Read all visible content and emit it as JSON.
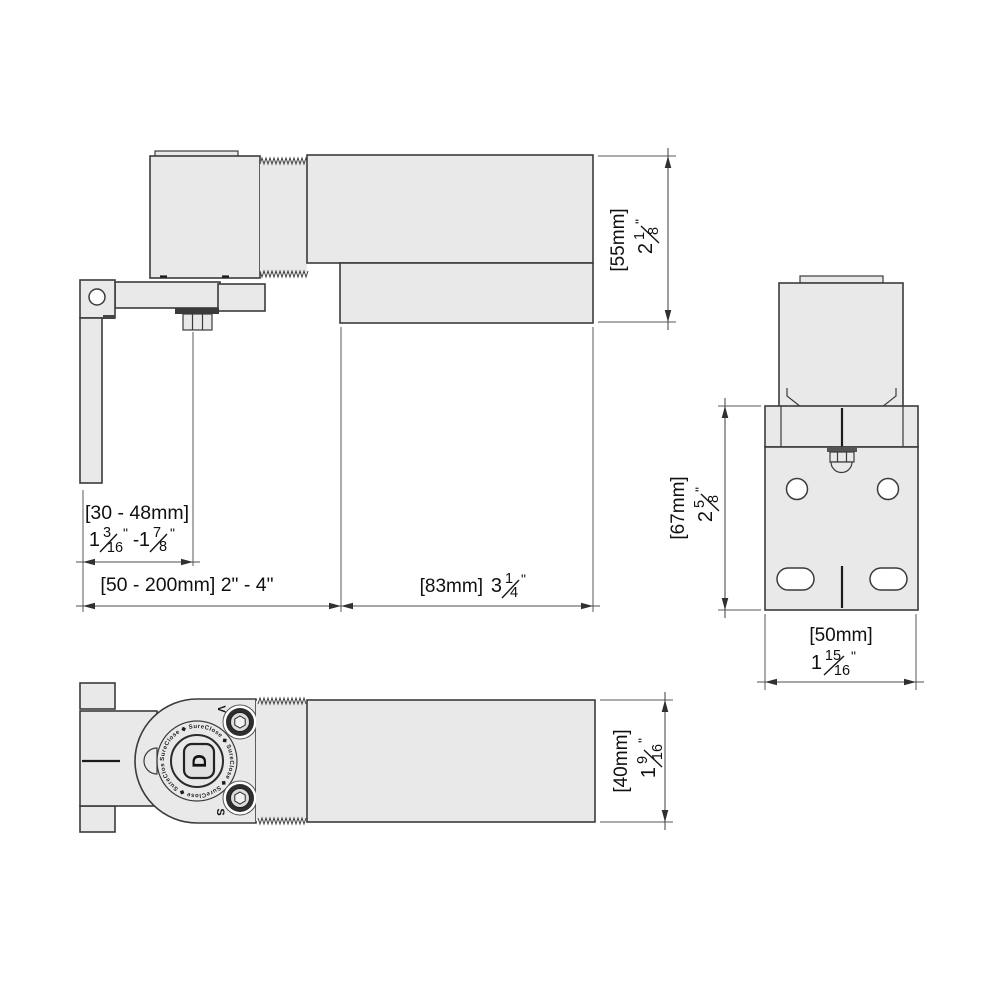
{
  "drawing": {
    "type": "door-closer-hinge-dimension-drawing",
    "background": "#ffffff",
    "part_fill": "#e9e9e9",
    "outline_color": "#3b3b3b",
    "dim_color": "#4f4f4f"
  },
  "dims": {
    "h55": {
      "metric": "[55mm]",
      "whole": "2",
      "num": "1",
      "den": "8"
    },
    "grip": {
      "metric": "[30 - 48mm]",
      "min": {
        "whole": "1",
        "num": "3",
        "den": "16"
      },
      "max": {
        "whole": "1",
        "num": "7",
        "den": "8"
      }
    },
    "mount": {
      "label": "[50 - 200mm] 2\" - 4\""
    },
    "l83": {
      "metric": "[83mm]",
      "whole": "3",
      "num": "1",
      "den": "4"
    },
    "h67": {
      "metric": "[67mm]",
      "whole": "2",
      "num": "5",
      "den": "8"
    },
    "w50": {
      "metric": "[50mm]",
      "whole": "1",
      "num": "15",
      "den": "16"
    },
    "d40": {
      "metric": "[40mm]",
      "whole": "1",
      "num": "9",
      "den": "16"
    }
  },
  "marks": {
    "inch": "\"",
    "dash": "-"
  },
  "branding": {
    "ring_text": "SureClose ◆ SureClose ◆ SureClose ◆ SureClose ◆ SureClose ◆ ",
    "logo_letter": "D",
    "adjust_top": "V",
    "adjust_bottom": "S"
  }
}
